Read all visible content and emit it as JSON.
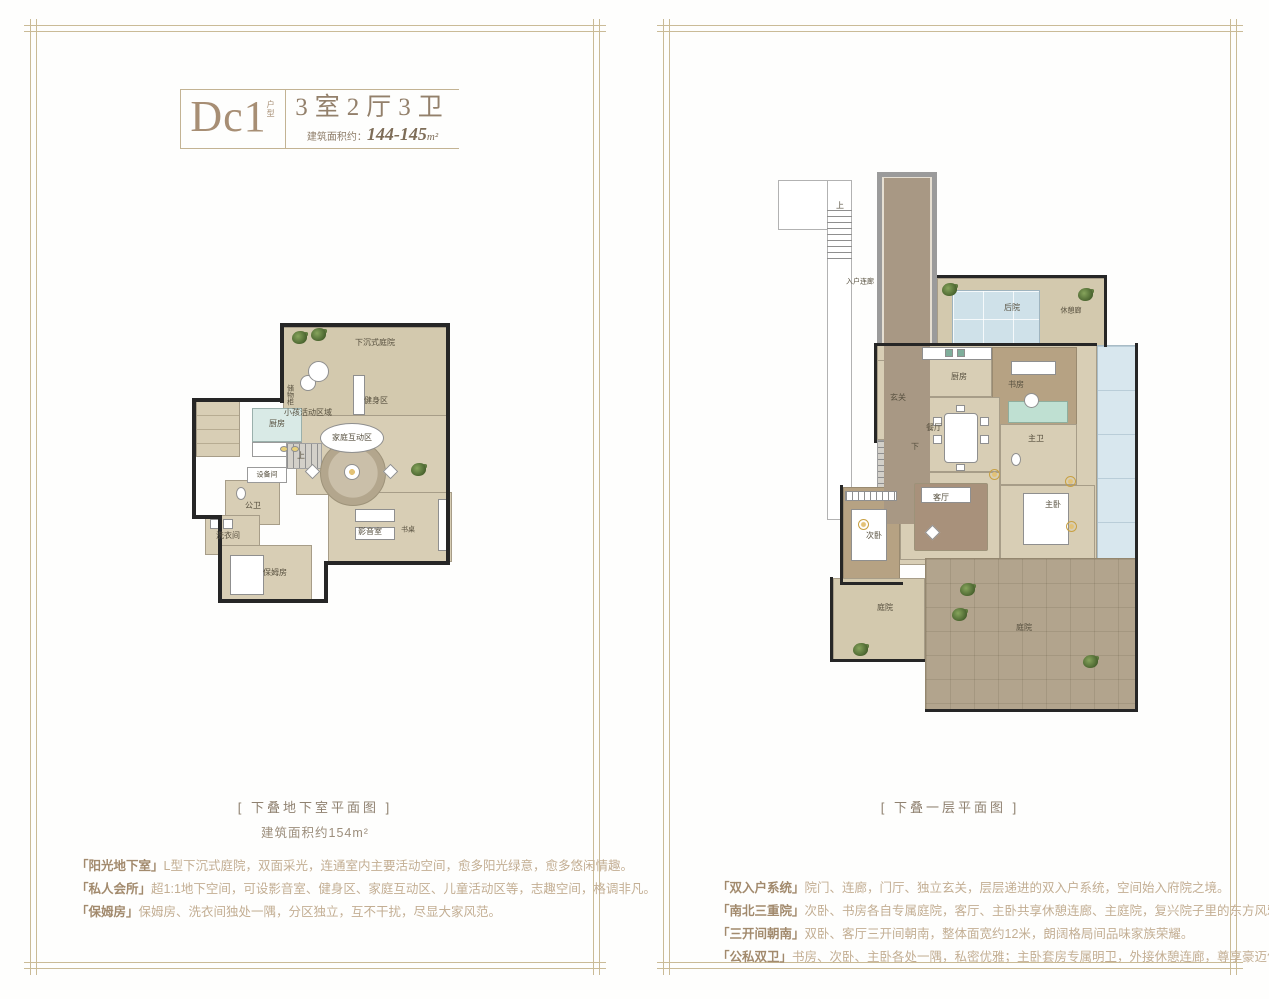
{
  "left_panel": {
    "title": {
      "code": "Dc1",
      "code_tag": "户型",
      "layout": "3室2厅3卫",
      "area_prefix": "建筑面积约：",
      "area_value": "144-145",
      "area_unit": "m²"
    },
    "caption": "[ 下叠地下室平面图 ]",
    "caption_area": "建筑面积约154m²",
    "features": [
      {
        "tag": "「阳光地下室」",
        "text": "L型下沉式庭院，双面采光，连通室内主要活动空间，愈多阳光绿意，愈多悠闲情趣。"
      },
      {
        "tag": "「私人会所」",
        "text": "超1:1地下空间，可设影音室、健身区、家庭互动区、儿童活动区等，志趣空间，格调非凡。"
      },
      {
        "tag": "「保姆房」",
        "text": "保姆房、洗衣间独处一隅，分区独立，互不干扰，尽显大家风范。"
      }
    ],
    "rooms": {
      "courtyard": "下沉式庭院",
      "gym": "健身区",
      "kids": "小孩活动区域",
      "family": "家庭互动区",
      "kitchen": "厨房",
      "cabinet": "储物柜",
      "equipment": "设备间",
      "bath": "公卫",
      "laundry": "洗衣间",
      "nanny": "保姆房",
      "av": "影音室",
      "desk": "书桌",
      "stairs_up": "上"
    }
  },
  "right_panel": {
    "caption": "[ 下叠一层平面图 ]",
    "features": [
      {
        "tag": "「双入户系统」",
        "text": "院门、连廊，门厅、独立玄关，层层递进的双入户系统，空间始入府院之境。"
      },
      {
        "tag": "「南北三重院」",
        "text": "次卧、书房各自专属庭院，客厅、主卧共享休憩连廊、主庭院，复兴院子里的东方风雅。"
      },
      {
        "tag": "「三开间朝南」",
        "text": "双卧、客厅三开间朝南，整体面宽约12米，朗阔格局间品味家族荣耀。"
      },
      {
        "tag": "「公私双卫」",
        "text": "书房、次卧、主卧各处一隅，私密优雅；主卧套房专属明卫，外接休憩连廊，尊享豪迈气度。"
      }
    ],
    "rooms": {
      "stairs_up": "上",
      "entry_corridor": "入户连廊",
      "backyard": "后院",
      "rest_corridor": "休憩廊",
      "kitchen": "厨房",
      "study": "书房",
      "foyer": "玄关",
      "dining": "餐厅",
      "master_bath": "主卫",
      "stairs_down": "下",
      "living": "客厅",
      "master_bed": "主卧",
      "second_bed": "次卧",
      "courtyard_west": "庭院",
      "courtyard_main": "庭院"
    }
  }
}
